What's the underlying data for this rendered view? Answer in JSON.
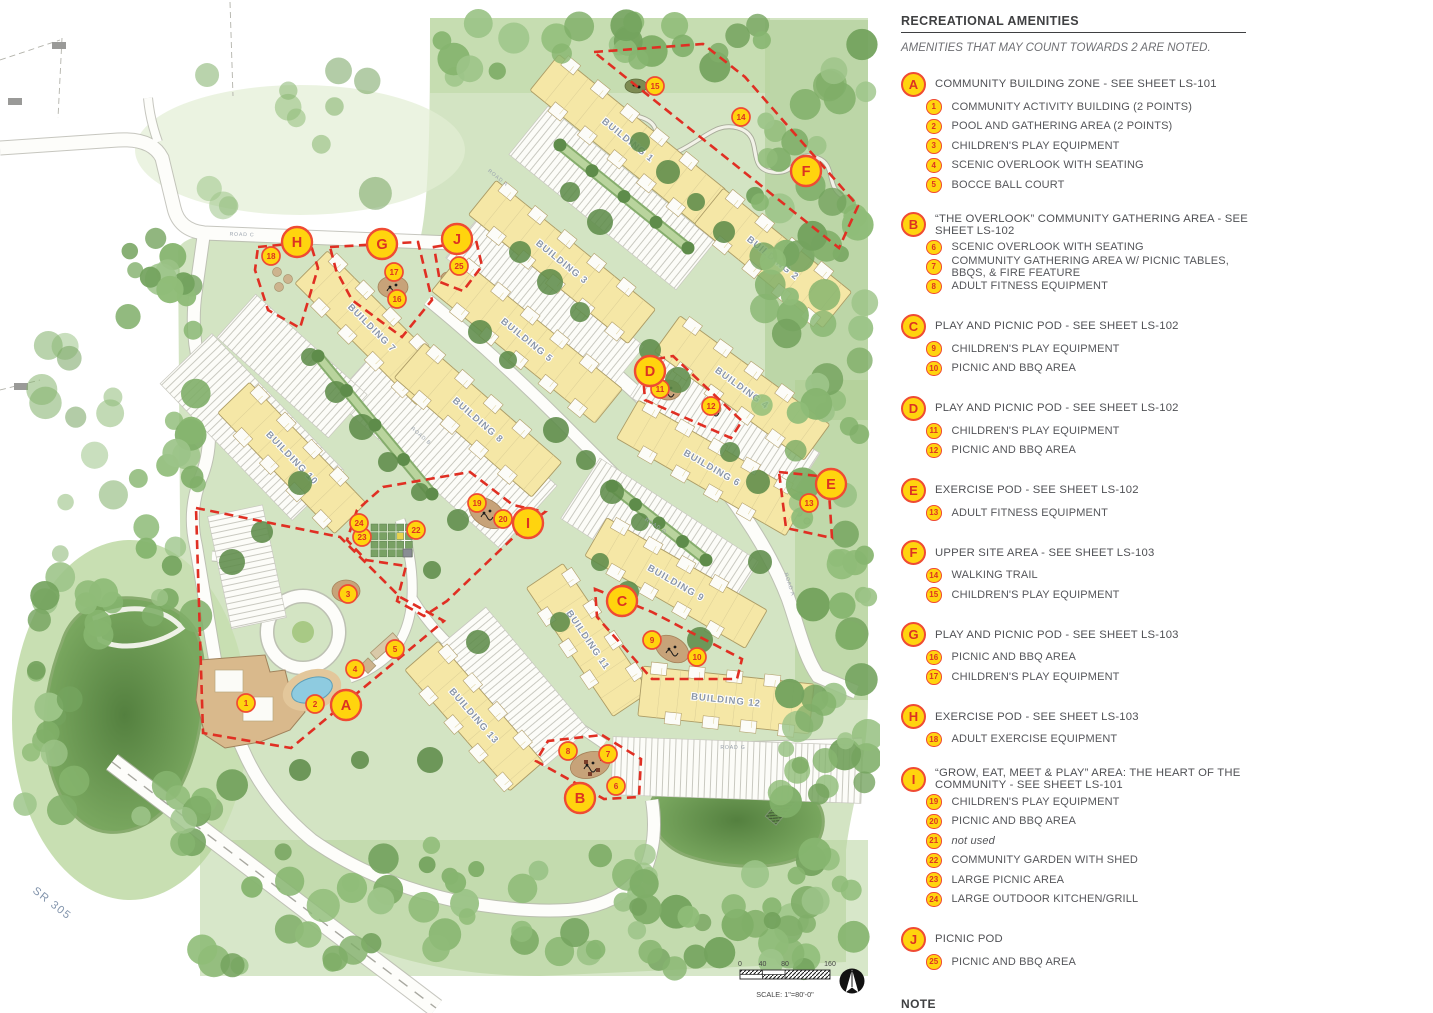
{
  "legend": {
    "title": "RECREATIONAL AMENITIES",
    "subtitle": "AMENITIES THAT MAY COUNT TOWARDS 2 ARE NOTED.",
    "groups": [
      {
        "letter": "A",
        "label": "COMMUNITY BUILDING ZONE - SEE SHEET LS-101",
        "items": [
          {
            "num": "1",
            "label": "COMMUNITY ACTIVITY BUILDING (2 POINTS)"
          },
          {
            "num": "2",
            "label": "POOL AND GATHERING AREA (2 POINTS)"
          },
          {
            "num": "3",
            "label": "CHILDREN'S PLAY EQUIPMENT"
          },
          {
            "num": "4",
            "label": "SCENIC OVERLOOK WITH SEATING"
          },
          {
            "num": "5",
            "label": "BOCCE BALL COURT"
          }
        ]
      },
      {
        "letter": "B",
        "label": "“THE OVERLOOK” COMMUNITY GATHERING AREA - SEE SHEET LS-102",
        "items": [
          {
            "num": "6",
            "label": "SCENIC OVERLOOK WITH SEATING"
          },
          {
            "num": "7",
            "label": "COMMUNITY GATHERING AREA W/ PICNIC TABLES, BBQS, & FIRE FEATURE"
          },
          {
            "num": "8",
            "label": "ADULT FITNESS EQUIPMENT"
          }
        ]
      },
      {
        "letter": "C",
        "label": "PLAY AND PICNIC POD - SEE SHEET LS-102",
        "items": [
          {
            "num": "9",
            "label": "CHILDREN'S PLAY EQUIPMENT"
          },
          {
            "num": "10",
            "label": "PICNIC AND BBQ AREA"
          }
        ]
      },
      {
        "letter": "D",
        "label": "PLAY AND PICNIC POD - SEE SHEET LS-102",
        "items": [
          {
            "num": "11",
            "label": "CHILDREN'S PLAY EQUIPMENT"
          },
          {
            "num": "12",
            "label": "PICNIC AND BBQ AREA"
          }
        ]
      },
      {
        "letter": "E",
        "label": "EXERCISE POD - SEE SHEET LS-102",
        "items": [
          {
            "num": "13",
            "label": "ADULT FITNESS EQUIPMENT"
          }
        ]
      },
      {
        "letter": "F",
        "label": "UPPER SITE AREA - SEE SHEET LS-103",
        "items": [
          {
            "num": "14",
            "label": "WALKING TRAIL"
          },
          {
            "num": "15",
            "label": "CHILDREN'S PLAY EQUIPMENT"
          }
        ]
      },
      {
        "letter": "G",
        "label": "PLAY AND PICNIC POD - SEE SHEET LS-103",
        "items": [
          {
            "num": "16",
            "label": "PICNIC AND BBQ AREA"
          },
          {
            "num": "17",
            "label": "CHILDREN'S PLAY EQUIPMENT"
          }
        ]
      },
      {
        "letter": "H",
        "label": "EXERCISE POD - SEE SHEET LS-103",
        "items": [
          {
            "num": "18",
            "label": "ADULT EXERCISE EQUIPMENT"
          }
        ]
      },
      {
        "letter": "I",
        "label": "“GROW, EAT, MEET & PLAY” AREA: THE HEART OF THE COMMUNITY - SEE SHEET LS-101",
        "items": [
          {
            "num": "19",
            "label": "CHILDREN'S PLAY EQUIPMENT"
          },
          {
            "num": "20",
            "label": "PICNIC AND BBQ AREA"
          },
          {
            "num": "21",
            "label": "not used",
            "italic": true
          },
          {
            "num": "22",
            "label": "COMMUNITY GARDEN WITH SHED"
          },
          {
            "num": "23",
            "label": "LARGE PICNIC AREA"
          },
          {
            "num": "24",
            "label": "LARGE OUTDOOR KITCHEN/GRILL"
          }
        ]
      },
      {
        "letter": "J",
        "label": "PICNIC POD",
        "items": [
          {
            "num": "25",
            "label": "PICNIC AND BBQ AREA"
          }
        ]
      }
    ],
    "note_title": "NOTE",
    "note_text": "See Sheets LS-104 and LS-105 for example images of site amenities."
  },
  "map": {
    "buildings": [
      {
        "label": "BUILDING 1",
        "x": 628,
        "y": 140,
        "len": 215,
        "w": 46,
        "a": 39
      },
      {
        "label": "BUILDING 2",
        "x": 773,
        "y": 258,
        "len": 165,
        "w": 46,
        "a": 39
      },
      {
        "label": "BUILDING 3",
        "x": 562,
        "y": 262,
        "len": 205,
        "w": 44,
        "a": 39
      },
      {
        "label": "BUILDING 5",
        "x": 527,
        "y": 340,
        "len": 210,
        "w": 44,
        "a": 39
      },
      {
        "label": "BUILDING 4",
        "x": 742,
        "y": 388,
        "len": 185,
        "w": 44,
        "a": 36
      },
      {
        "label": "BUILDING 6",
        "x": 712,
        "y": 468,
        "len": 195,
        "w": 44,
        "a": 30
      },
      {
        "label": "BUILDING 7",
        "x": 372,
        "y": 328,
        "len": 172,
        "w": 46,
        "a": 45
      },
      {
        "label": "BUILDING 8",
        "x": 478,
        "y": 420,
        "len": 182,
        "w": 46,
        "a": 41
      },
      {
        "label": "BUILDING 9",
        "x": 676,
        "y": 583,
        "len": 185,
        "w": 44,
        "a": 30
      },
      {
        "label": "BUILDING 10",
        "x": 292,
        "y": 458,
        "len": 168,
        "w": 44,
        "a": 46
      },
      {
        "label": "BUILDING 11",
        "x": 588,
        "y": 640,
        "len": 155,
        "w": 44,
        "a": 56
      },
      {
        "label": "BUILDING 12",
        "x": 726,
        "y": 700,
        "len": 172,
        "w": 50,
        "a": 6
      },
      {
        "label": "BUILDING 13",
        "x": 474,
        "y": 716,
        "len": 160,
        "w": 44,
        "a": 49
      }
    ],
    "letter_markers": [
      {
        "label": "A",
        "x": 346,
        "y": 705
      },
      {
        "label": "B",
        "x": 580,
        "y": 798
      },
      {
        "label": "C",
        "x": 622,
        "y": 601
      },
      {
        "label": "D",
        "x": 650,
        "y": 371
      },
      {
        "label": "E",
        "x": 831,
        "y": 484
      },
      {
        "label": "F",
        "x": 806,
        "y": 171
      },
      {
        "label": "G",
        "x": 382,
        "y": 244
      },
      {
        "label": "H",
        "x": 297,
        "y": 242
      },
      {
        "label": "I",
        "x": 528,
        "y": 523
      },
      {
        "label": "J",
        "x": 457,
        "y": 239
      }
    ],
    "number_markers": [
      {
        "label": "1",
        "x": 246,
        "y": 703
      },
      {
        "label": "2",
        "x": 315,
        "y": 704
      },
      {
        "label": "3",
        "x": 348,
        "y": 594
      },
      {
        "label": "4",
        "x": 355,
        "y": 669
      },
      {
        "label": "5",
        "x": 395,
        "y": 649
      },
      {
        "label": "6",
        "x": 616,
        "y": 786
      },
      {
        "label": "7",
        "x": 608,
        "y": 754
      },
      {
        "label": "8",
        "x": 568,
        "y": 751
      },
      {
        "label": "9",
        "x": 652,
        "y": 640
      },
      {
        "label": "10",
        "x": 697,
        "y": 657
      },
      {
        "label": "11",
        "x": 660,
        "y": 389
      },
      {
        "label": "12",
        "x": 711,
        "y": 406
      },
      {
        "label": "13",
        "x": 809,
        "y": 503
      },
      {
        "label": "14",
        "x": 741,
        "y": 117
      },
      {
        "label": "15",
        "x": 655,
        "y": 86
      },
      {
        "label": "16",
        "x": 397,
        "y": 299
      },
      {
        "label": "17",
        "x": 394,
        "y": 272
      },
      {
        "label": "18",
        "x": 271,
        "y": 256
      },
      {
        "label": "19",
        "x": 477,
        "y": 503
      },
      {
        "label": "20",
        "x": 503,
        "y": 519
      },
      {
        "label": "22",
        "x": 416,
        "y": 530
      },
      {
        "label": "23",
        "x": 362,
        "y": 537
      },
      {
        "label": "24",
        "x": 359,
        "y": 523
      },
      {
        "label": "25",
        "x": 459,
        "y": 266
      }
    ],
    "road_labels": [
      {
        "t": "ROAD A",
        "x": 497,
        "y": 179,
        "a": 39
      },
      {
        "t": "ROAD A",
        "x": 788,
        "y": 585,
        "a": 72
      },
      {
        "t": "ROAD B",
        "x": 420,
        "y": 437,
        "a": 41
      },
      {
        "t": "ROAD C",
        "x": 242,
        "y": 236,
        "a": 2
      },
      {
        "t": "ROAD D",
        "x": 655,
        "y": 527,
        "a": 33
      },
      {
        "t": "ROAD G",
        "x": 733,
        "y": 749,
        "a": 0
      }
    ],
    "highway_label": {
      "t": "SR 305",
      "x": 50,
      "y": 906,
      "a": 38
    },
    "scale_bar": {
      "ticks": [
        "0",
        "40",
        "80",
        "160"
      ],
      "caption": "SCALE: 1\"=80'-0\""
    }
  },
  "colors": {
    "badge_fill": "#FFD40E",
    "badge_ring": "#EF4B33",
    "badge_text": "#DC3222",
    "zone_dash": "#E02F23",
    "building_fill": "#F5E7A6",
    "site_green": "#D3E4C3",
    "legend_text": "#55565A"
  }
}
